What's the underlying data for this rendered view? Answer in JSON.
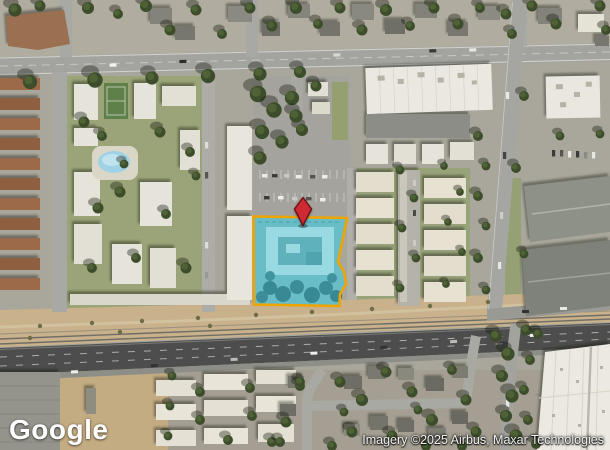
{
  "branding": {
    "logo_text": "Google"
  },
  "attribution": {
    "text": "Imagery ©2025 Airbus, Maxar Technologies"
  },
  "map": {
    "view_type": "satellite",
    "parcel": {
      "fill_color": "rgba(72,198,214,0.40)",
      "outline_color": "#F0A400"
    },
    "pin": {
      "color": "#CD2B31",
      "outline_color": "#6E1013"
    }
  }
}
